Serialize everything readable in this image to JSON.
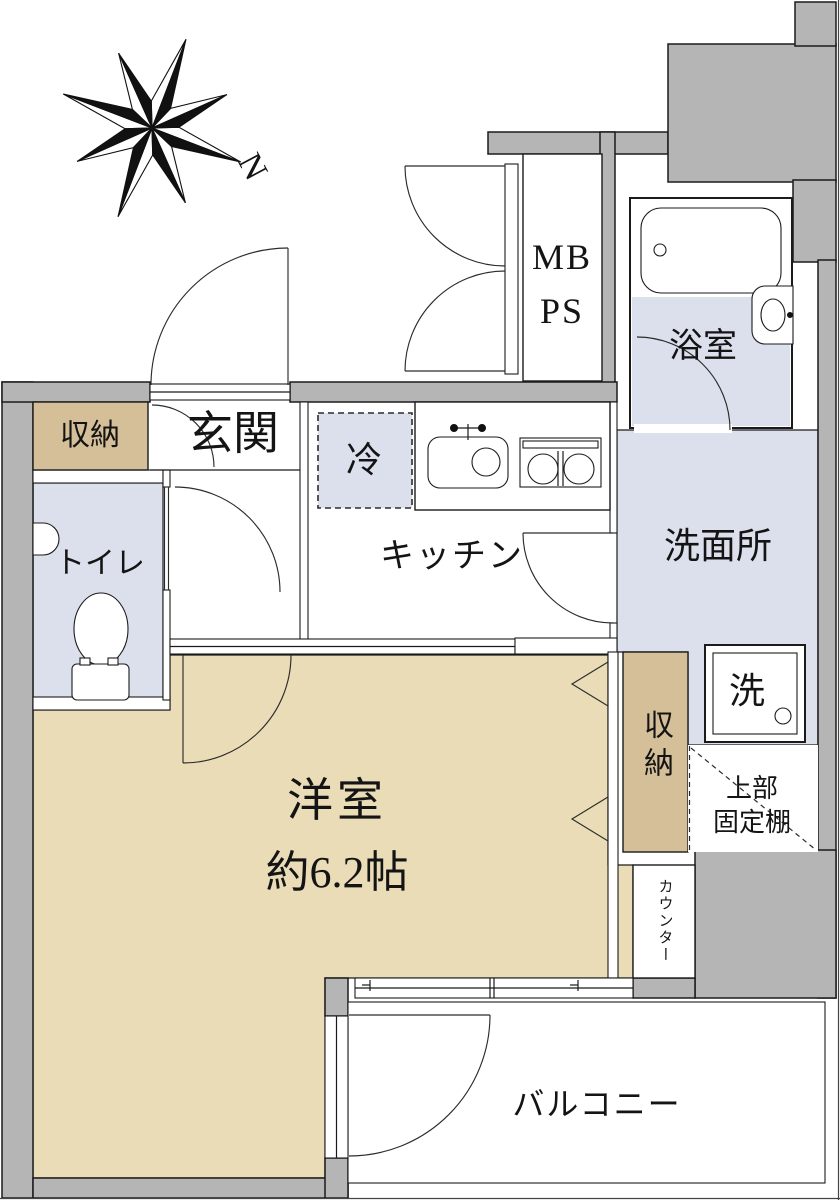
{
  "floorplan": {
    "compass": {
      "north_label": "N"
    },
    "rooms": {
      "mb_line1": "MB",
      "mb_line2": "PS",
      "bathroom": "浴室",
      "storage_entry": "収納",
      "entrance": "玄関",
      "fridge": "冷",
      "kitchen": "キッチン",
      "washroom": "洗面所",
      "toilet": "トイレ",
      "washer": "洗",
      "storage_right": "収納",
      "upper_shelf_line1": "上部",
      "upper_shelf_line2": "固定棚",
      "counter": "カウンター",
      "western_room_name": "洋室",
      "western_room_size": "約6.2帖",
      "balcony": "バルコニー"
    },
    "colors": {
      "wall": "#b5b5b5",
      "room_floor": "#e9dcb7",
      "closet": "#d5bf98",
      "wet_floor": "#dbe0ec",
      "line": "#1b1b1b"
    }
  }
}
